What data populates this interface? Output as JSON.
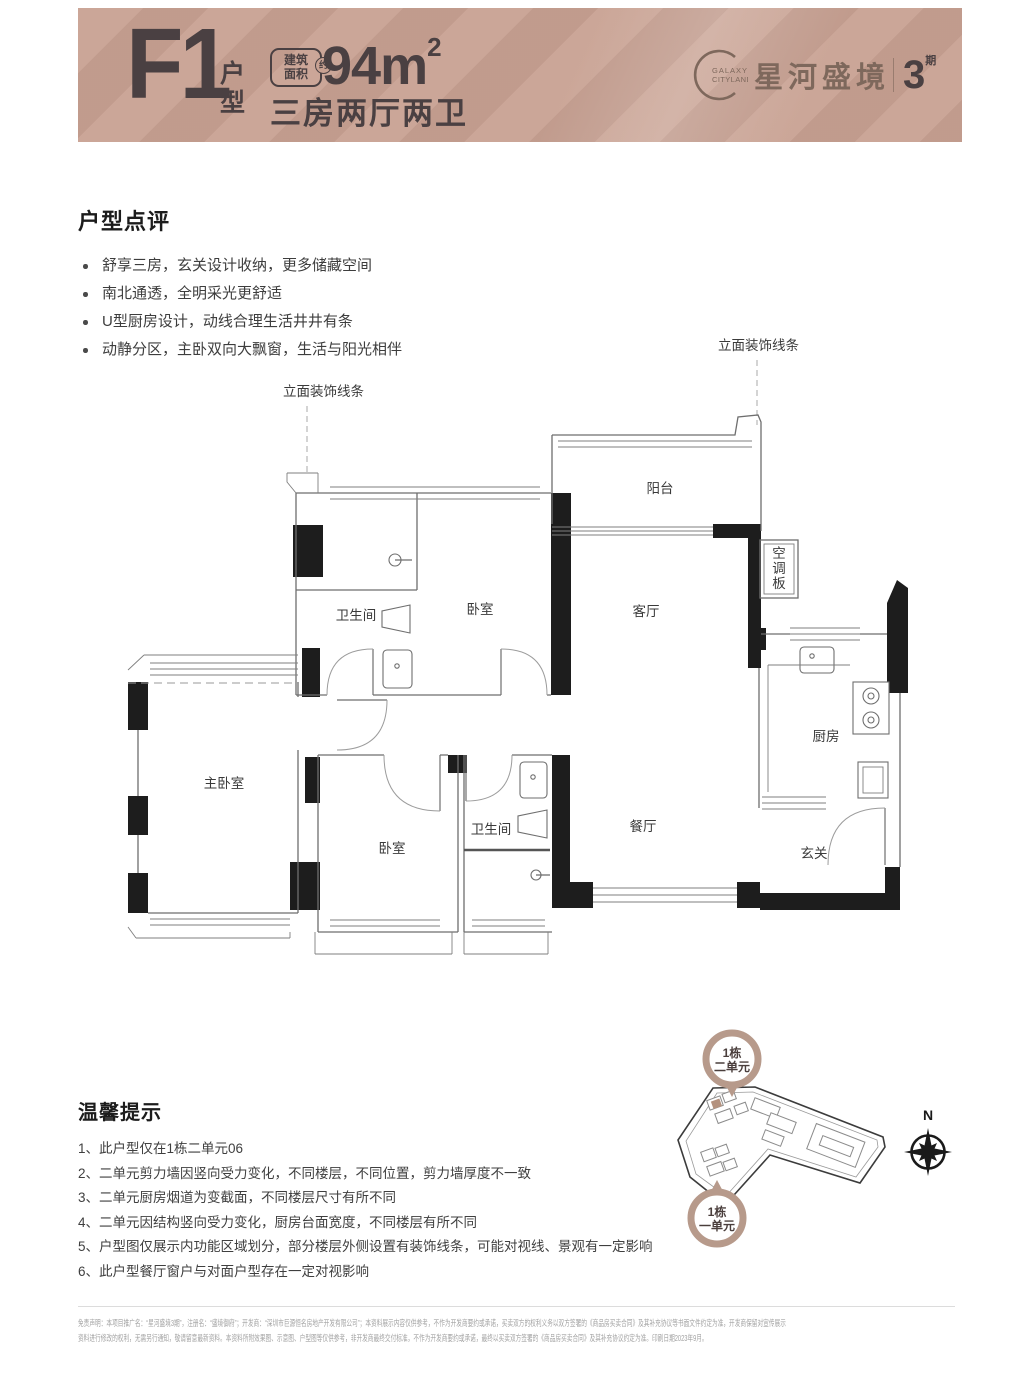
{
  "header": {
    "unit_code": "F1",
    "unit_label": "户型",
    "area_badge_line1": "建筑",
    "area_badge_line2": "面积",
    "area_badge_approx": "约",
    "area_value": "94m",
    "area_sup": "2",
    "layout_desc": "三房两厅两卫",
    "brand_en_line1": "GALAXY",
    "brand_en_line2": "CITYLAND",
    "brand_cn": "星河盛境",
    "brand_phase_num": "3",
    "brand_phase_unit": "期"
  },
  "review": {
    "title": "户型点评",
    "bullets": [
      "舒享三房，玄关设计收纳，更多储藏空间",
      "南北通透，全明采光更舒适",
      "U型厨房设计，动线合理生活井井有条",
      "动静分区，主卧双向大飘窗，生活与阳光相伴"
    ]
  },
  "floorplan": {
    "callout_left": "立面装饰线条",
    "callout_right": "立面装饰线条",
    "rooms": {
      "balcony": "阳台",
      "living": "客厅",
      "dining": "餐厅",
      "kitchen": "厨房",
      "entry": "玄关",
      "bath_top": "卫生间",
      "bedroom_top": "卧室",
      "master": "主卧室",
      "bedroom_bottom": "卧室",
      "bath_bottom": "卫生间"
    },
    "ac_chars": [
      "空",
      "调",
      "板"
    ]
  },
  "tips": {
    "title": "温馨提示",
    "items": [
      "1、此户型仅在1栋二单元06",
      "2、二单元剪力墙因竖向受力变化，不同楼层，不同位置，剪力墙厚度不一致",
      "3、二单元厨房烟道为变截面，不同楼层尺寸有所不同",
      "4、二单元因结构竖向受力变化，厨房台面宽度，不同楼层有所不同",
      "5、户型图仅展示内功能区域划分，部分楼层外侧设置有装饰线条，可能对视线、景观有一定影响",
      "6、此户型餐厅窗户与对面户型存在一定对视影响"
    ]
  },
  "siteplan": {
    "callout_top_line1": "1栋",
    "callout_top_line2": "二单元",
    "callout_bottom_line1": "1栋",
    "callout_bottom_line2": "一单元",
    "compass_label": "N"
  },
  "footer": {
    "line1": "免责声明：本项目推广名：“星河盛境3期”，注册名：“盛境御府”；开发商：“深圳市巨源恒名房地产开发有限公司”；本资料展示内容仅供参考，不作为开发商要约或承诺，买卖双方的权利义务以双方签署的《商品房买卖合同》及其补充协议等书面文件约定为准，开发商保留对宣传展示",
    "line2": "资料进行修改的权利，无需另行通知，敬请留意最新资料。本资料所附效果图、示意图、户型图等仅供参考，非开发商最终交付标准，不作为开发商要约或承诺，最终以买卖双方签署的《商品房买卖合同》及其补充协议约定为准。印刷日期2023年9月。"
  }
}
